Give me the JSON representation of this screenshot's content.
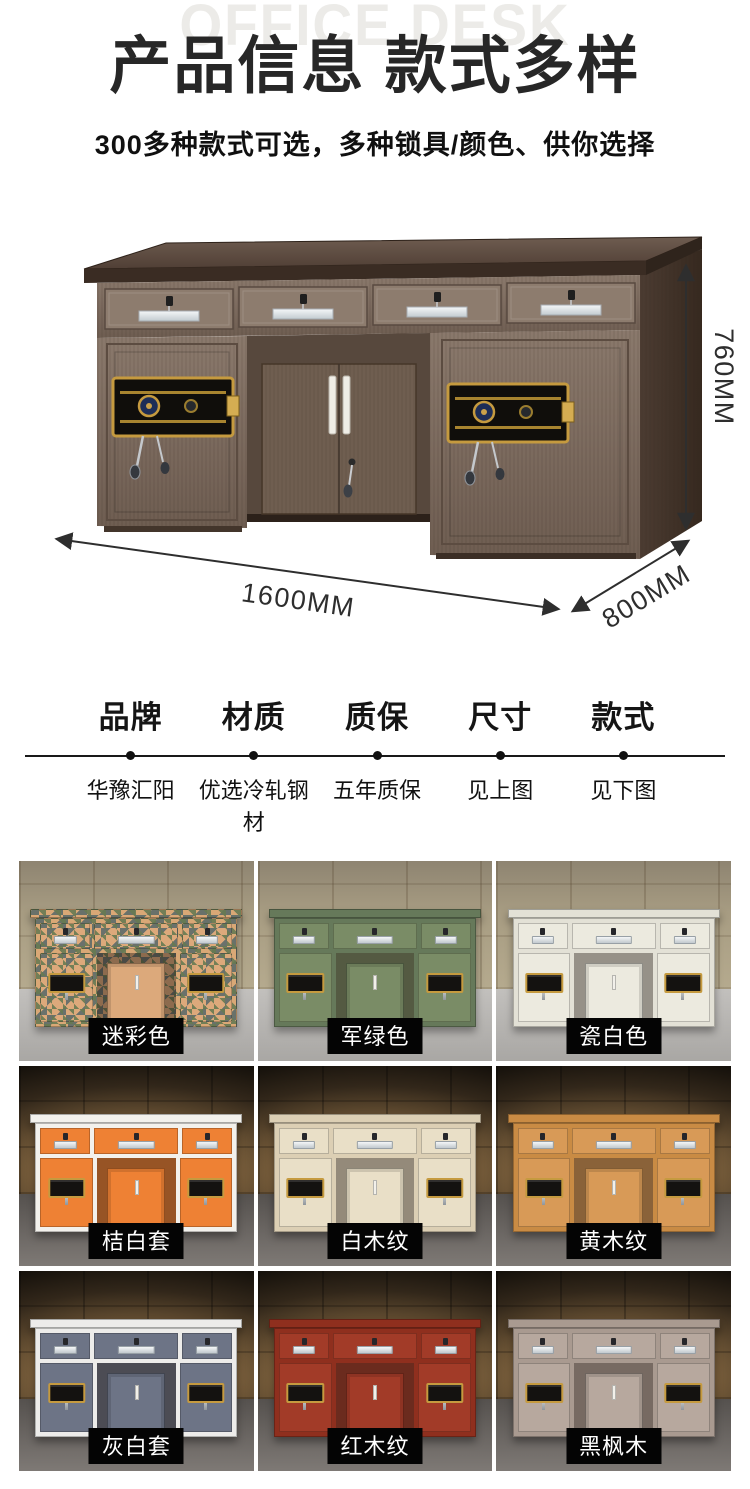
{
  "header": {
    "watermark": "OFFICE DESK",
    "title": "产品信息 款式多样",
    "subtitle": "300多种款式可选，多种锁具/颜色、供你选择"
  },
  "hero": {
    "dim_height": "760MM",
    "dim_width": "1600MM",
    "dim_depth": "800MM"
  },
  "specs": [
    {
      "label": "品牌",
      "value": "华豫汇阳"
    },
    {
      "label": "材质",
      "value": "优选冷轧钢材"
    },
    {
      "label": "质保",
      "value": "五年质保"
    },
    {
      "label": "尺寸",
      "value": "见上图"
    },
    {
      "label": "款式",
      "value": "见下图"
    }
  ],
  "styles": {
    "items": [
      {
        "label": "迷彩色",
        "variant": "camo",
        "frame": "#d9a876",
        "panel": "#dca97b"
      },
      {
        "label": "军绿色",
        "variant": "solid",
        "frame": "#66795a",
        "panel": "#7a8c66"
      },
      {
        "label": "瓷白色",
        "variant": "solid",
        "frame": "#e3e1d6",
        "panel": "#eceadf"
      },
      {
        "label": "桔白套",
        "variant": "two-tone",
        "frame": "#f3f1ec",
        "panel": "#ee8134"
      },
      {
        "label": "白木纹",
        "variant": "wood",
        "frame": "#dccfb4",
        "panel": "#e9dfc7"
      },
      {
        "label": "黄木纹",
        "variant": "wood",
        "frame": "#c98b44",
        "panel": "#d89a57"
      },
      {
        "label": "灰白套",
        "variant": "two-tone",
        "frame": "#edecea",
        "panel": "#6d7486"
      },
      {
        "label": "红木纹",
        "variant": "wood",
        "frame": "#8f2f1e",
        "panel": "#a23b28"
      },
      {
        "label": "黑枫木",
        "variant": "wood",
        "frame": "#a99a90",
        "panel": "#b7a89e"
      }
    ]
  },
  "note": {
    "prefix": "注明：",
    "text": "保险桌种类较多，如需其他款式，详情请咨询客服，支持定制，厂家直销"
  },
  "colors": {
    "accent_red": "#e60012",
    "title_dark": "#272727",
    "label_bg": "#040404",
    "label_fg": "#ffffff",
    "lock_gold": "#c59a3f"
  }
}
